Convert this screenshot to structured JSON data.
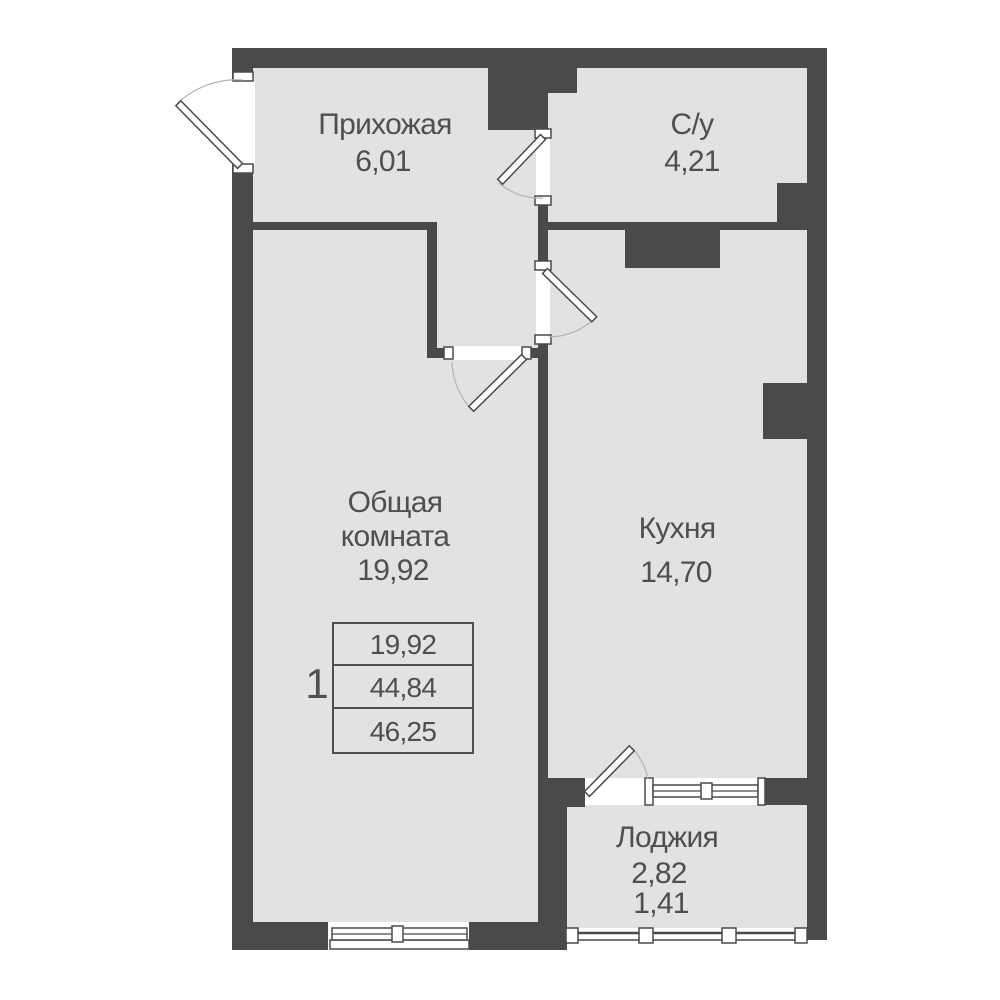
{
  "rooms": {
    "hallway": {
      "name": "Прихожая",
      "area": "6,01"
    },
    "bathroom": {
      "name": "С/у",
      "area": "4,21"
    },
    "living": {
      "name_line1": "Общая",
      "name_line2": "комната",
      "area": "19,92"
    },
    "kitchen": {
      "name": "Кухня",
      "area": "14,70"
    },
    "loggia": {
      "name": "Лоджия",
      "area_full": "2,82",
      "area_reduced": "1,41"
    }
  },
  "area_table": {
    "apartment_number": "1",
    "living_area": "19,92",
    "area_without_loggia": "44,84",
    "total_area": "46,25"
  },
  "colors": {
    "wall": "#4a4a4a",
    "floor": "#e2e2e2",
    "text": "#4f4f4f",
    "arc": "#b3b3b3",
    "bg": "#ffffff"
  }
}
